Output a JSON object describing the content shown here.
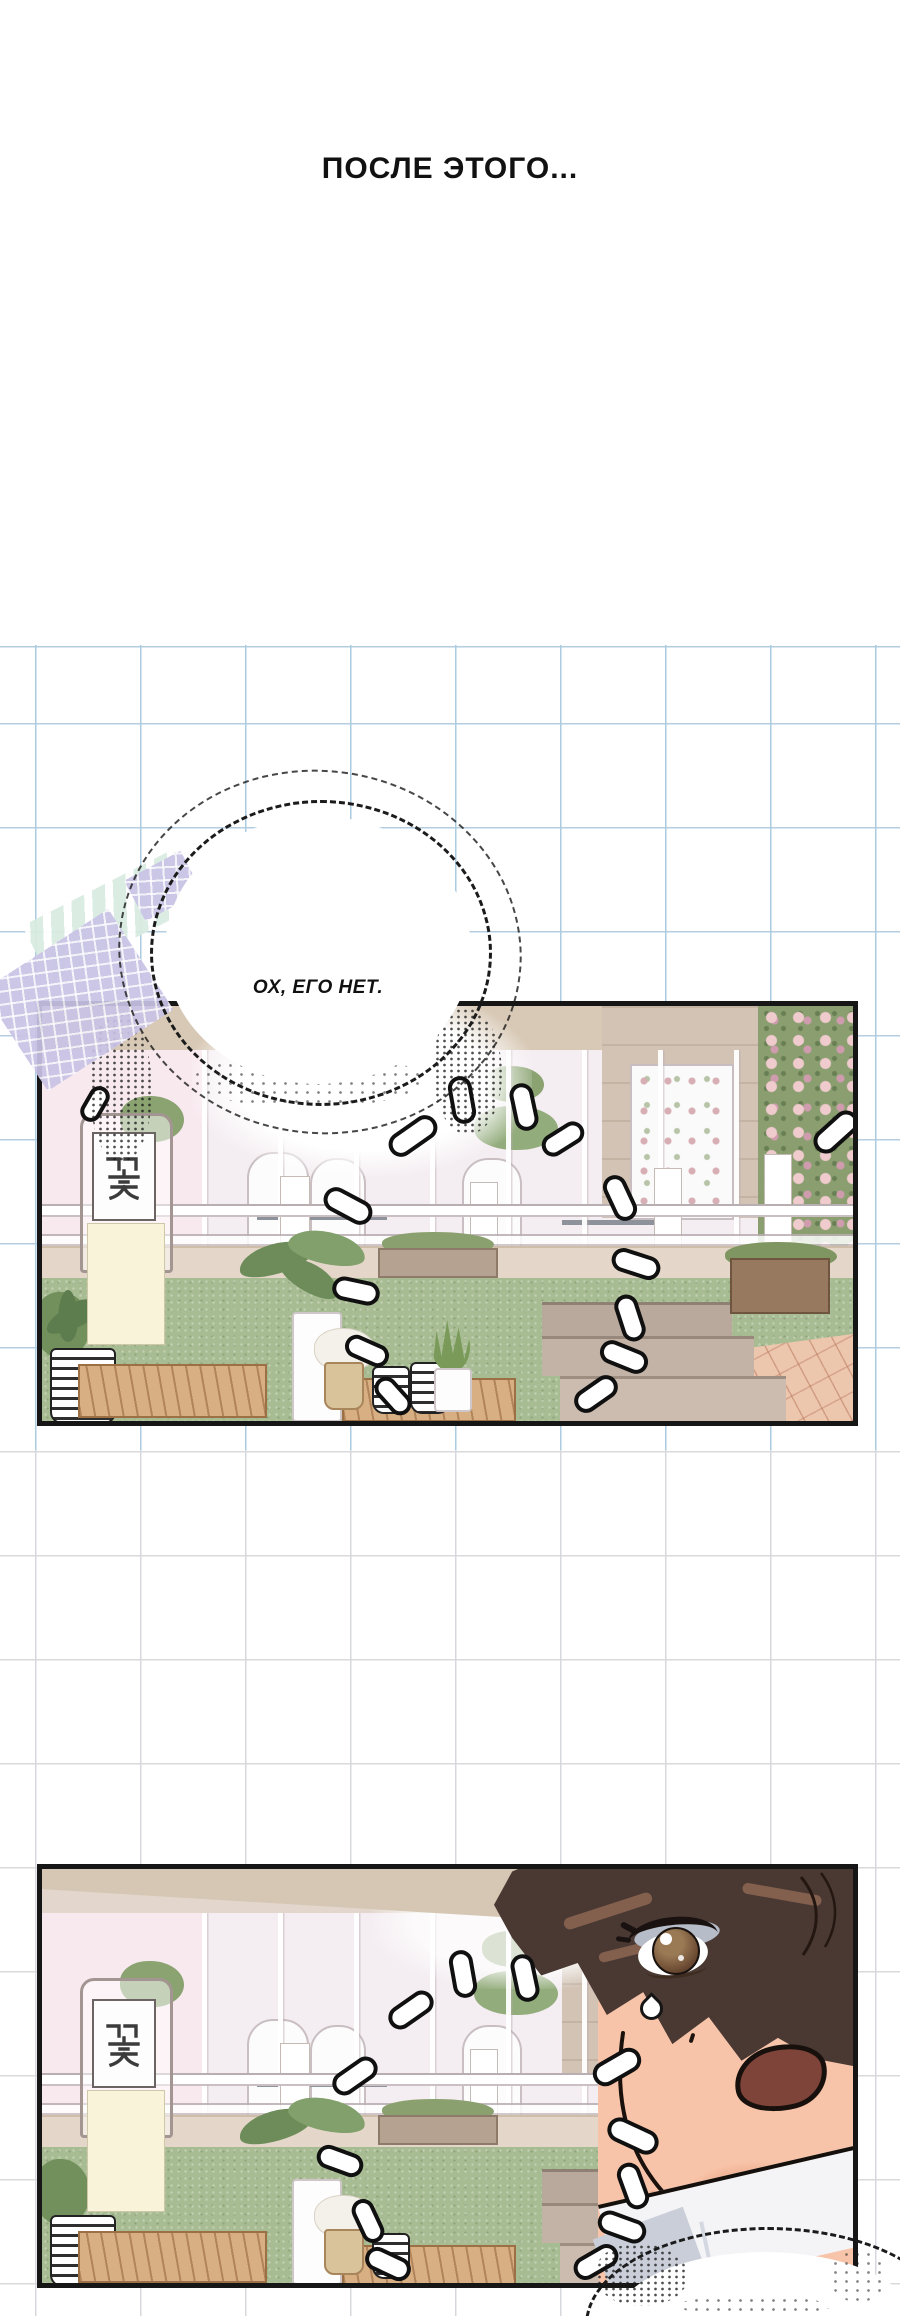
{
  "comic": {
    "caption": "ПОСЛЕ ЭТОГО...",
    "speech_bubble": "ОХ, ЕГО НЕТ.",
    "sign_text": "꽃",
    "panel_count": 2,
    "panels": [
      {
        "description": "flower shop storefront: glass windows, plants, turf, steps"
      },
      {
        "description": "same storefront with close-up of surprised dark-haired boy"
      }
    ],
    "colors": {
      "page_bg": "#ffffff",
      "panel_border": "#161616",
      "grid_blue": "#9dc2dc",
      "grid_gray": "#d6d6da",
      "awning": "#d8c9b6",
      "wall_pink": "#f8e9ef",
      "grass": "#a8bc93",
      "tiles": "#edc6ae",
      "tape_mint": "#d9ece1",
      "tape_lavender": "#c9c3e6",
      "hair": "#4a3933",
      "skin": "#f8c4a9",
      "mouth": "#7e4339"
    }
  }
}
